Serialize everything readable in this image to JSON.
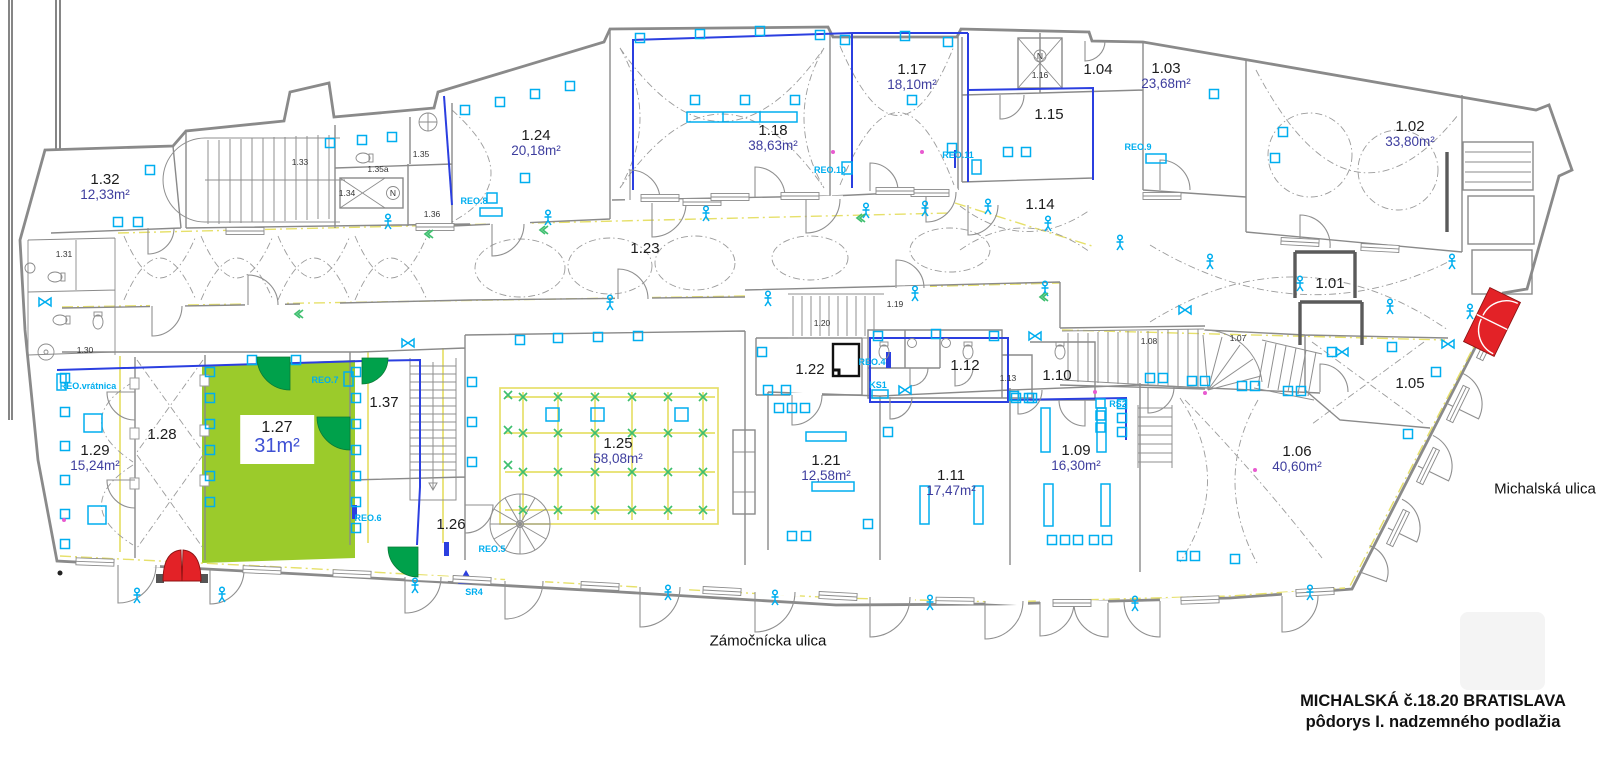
{
  "title_block": {
    "line1": "MICHALSKÁ č.18.20 BRATISLAVA",
    "line2": "pôdorys I. nadzemného podlažia"
  },
  "streets": [
    {
      "name": "Zámočnícka ulica",
      "x": 768,
      "y": 641
    },
    {
      "name": "Michalská ulica",
      "x": 1545,
      "y": 489
    }
  ],
  "rooms": [
    {
      "id": "1.32",
      "area": "12,33m²",
      "x": 105,
      "y": 181
    },
    {
      "id": "1.24",
      "area": "20,18m²",
      "x": 536,
      "y": 137
    },
    {
      "id": "1.18",
      "area": "38,63m²",
      "x": 773,
      "y": 132
    },
    {
      "id": "1.17",
      "area": "18,10m²",
      "x": 912,
      "y": 71
    },
    {
      "id": "1.04",
      "x": 1098,
      "y": 71
    },
    {
      "id": "1.03",
      "area": "23,68m²",
      "x": 1166,
      "y": 70
    },
    {
      "id": "1.02",
      "area": "33,80m²",
      "x": 1410,
      "y": 128
    },
    {
      "id": "1.15",
      "x": 1049,
      "y": 116
    },
    {
      "id": "1.14",
      "x": 1040,
      "y": 206
    },
    {
      "id": "1.23",
      "x": 645,
      "y": 250
    },
    {
      "id": "1.01",
      "x": 1330,
      "y": 285
    },
    {
      "id": "1.22",
      "x": 810,
      "y": 371
    },
    {
      "id": "1.12",
      "x": 965,
      "y": 367
    },
    {
      "id": "1.10",
      "x": 1057,
      "y": 377
    },
    {
      "id": "1.05",
      "x": 1410,
      "y": 385
    },
    {
      "id": "1.29",
      "area": "15,24m²",
      "x": 95,
      "y": 452
    },
    {
      "id": "1.28",
      "x": 162,
      "y": 436
    },
    {
      "id": "1.27",
      "area": "31m²",
      "x": 277,
      "y": 441,
      "boxed": true
    },
    {
      "id": "1.37",
      "x": 384,
      "y": 404
    },
    {
      "id": "1.26",
      "x": 451,
      "y": 526
    },
    {
      "id": "1.25",
      "area": "58,08m²",
      "x": 618,
      "y": 445
    },
    {
      "id": "1.21",
      "area": "12,58m²",
      "x": 826,
      "y": 462
    },
    {
      "id": "1.11",
      "area": "17,47m²",
      "x": 951,
      "y": 477
    },
    {
      "id": "1.09",
      "area": "16,30m²",
      "x": 1076,
      "y": 452
    },
    {
      "id": "1.06",
      "area": "40,60m²",
      "x": 1297,
      "y": 453
    }
  ],
  "small_labels": [
    {
      "text": "1.31",
      "x": 64,
      "y": 254
    },
    {
      "text": "1.30",
      "x": 85,
      "y": 350
    },
    {
      "text": "1.33",
      "x": 300,
      "y": 162
    },
    {
      "text": "1.34",
      "x": 347,
      "y": 193
    },
    {
      "text": "1.35",
      "x": 421,
      "y": 154
    },
    {
      "text": "1.35a",
      "x": 378,
      "y": 169
    },
    {
      "text": "1.36",
      "x": 432,
      "y": 214
    },
    {
      "text": "1.16",
      "x": 1040,
      "y": 75
    },
    {
      "text": "1.19",
      "x": 895,
      "y": 304
    },
    {
      "text": "1.20",
      "x": 822,
      "y": 323
    },
    {
      "text": "1.08",
      "x": 1149,
      "y": 341
    },
    {
      "text": "1.07",
      "x": 1238,
      "y": 338
    },
    {
      "text": "1.13",
      "x": 1008,
      "y": 378
    },
    {
      "text": "N",
      "x": 393,
      "y": 193
    },
    {
      "text": "N",
      "x": 1040,
      "y": 56
    }
  ],
  "tech_labels": [
    {
      "text": "REO.vrátnica",
      "x": 88,
      "y": 386
    },
    {
      "text": "REO.7",
      "x": 325,
      "y": 380
    },
    {
      "text": "REO.8",
      "x": 474,
      "y": 201
    },
    {
      "text": "REO.9",
      "x": 1138,
      "y": 147
    },
    {
      "text": "REO.10",
      "x": 830,
      "y": 170
    },
    {
      "text": "REO.11",
      "x": 958,
      "y": 155
    },
    {
      "text": "REO.6",
      "x": 368,
      "y": 518
    },
    {
      "text": "REO.5",
      "x": 492,
      "y": 549
    },
    {
      "text": "SR4",
      "x": 474,
      "y": 592
    },
    {
      "text": "REO.4",
      "x": 872,
      "y": 362
    },
    {
      "text": "KS1",
      "x": 878,
      "y": 385
    },
    {
      "text": "RS2",
      "x": 1118,
      "y": 404
    }
  ],
  "colors": {
    "wall_gray": "#8a8a8a",
    "dark_wall": "#5a5a5a",
    "highlight_green": "#9bcb2b",
    "door_green": "#00a14b",
    "door_red": "#e32227",
    "cyan": "#00aeef",
    "reo_blue": "#2b3fe0",
    "line_yellow": "#e6e06a",
    "grid_green": "#3fbf6f",
    "area_text": "#3d3d9e",
    "area_text_bright": "#3f51d4",
    "room_text": "#1c1c1c",
    "magenta": "#e85bd0"
  }
}
